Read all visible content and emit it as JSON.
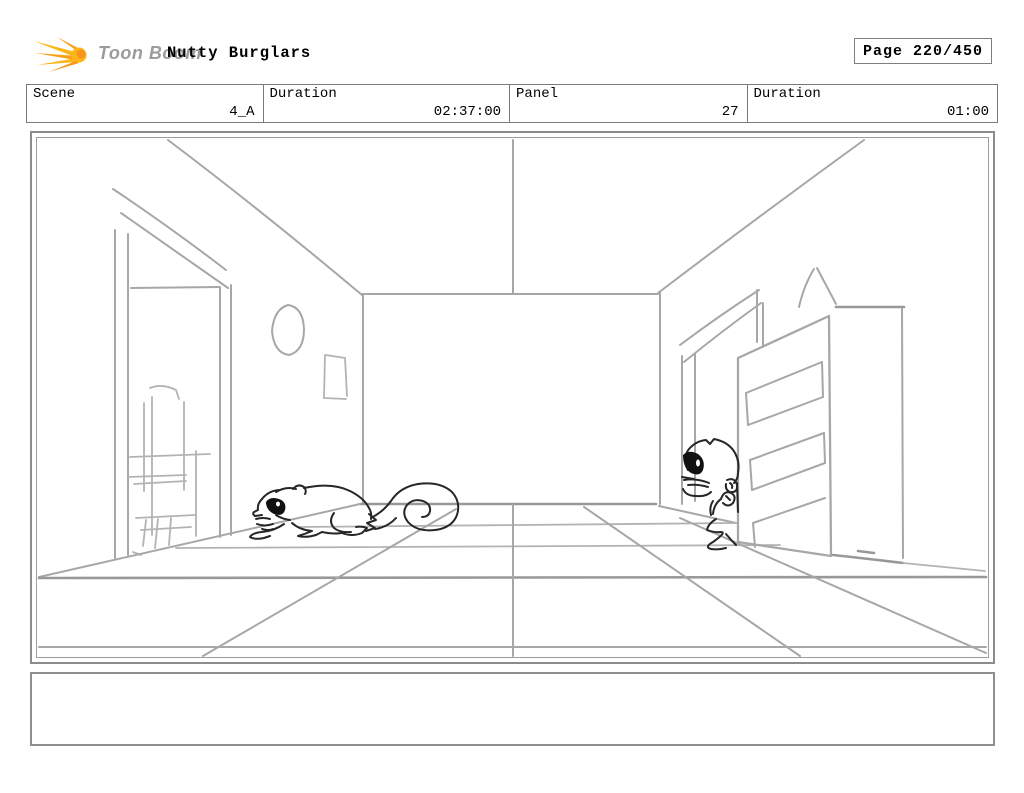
{
  "header": {
    "logo_text": "Toon Boom",
    "title": "Nutty Burglars",
    "page_label": "Page 220/450"
  },
  "info_row": {
    "cells": [
      {
        "label": "Scene",
        "value": "4_A"
      },
      {
        "label": "Duration",
        "value": "02:37:00"
      },
      {
        "label": "Panel",
        "value": "27"
      },
      {
        "label": "Duration",
        "value": "01:00"
      }
    ]
  },
  "caption": {
    "text": ""
  },
  "icons": {
    "logo": "toonboom-starburst-icon"
  },
  "colors": {
    "logo_yellow": "#FDB515",
    "logo_orange": "#F7941D",
    "logo_text_gray": "#9b9b9b",
    "border_gray": "#8c8c8c",
    "sketch_gray": "#a7a7a7",
    "character_ink": "#262626",
    "background": "#ffffff"
  }
}
